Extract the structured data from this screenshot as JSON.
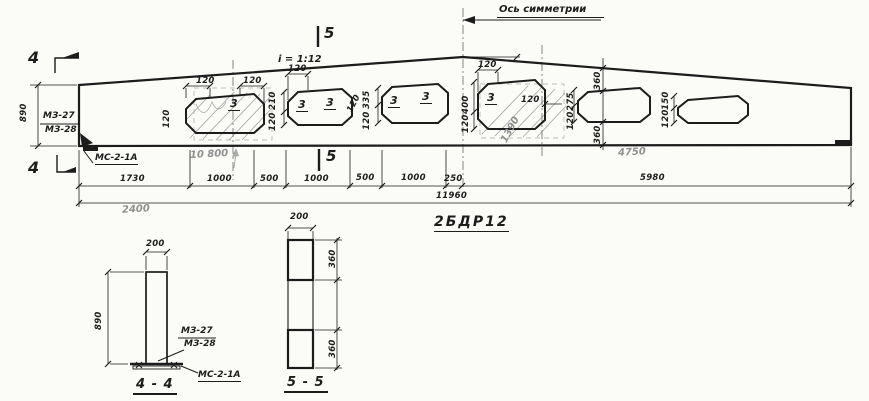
{
  "drawing": {
    "title": "2БДР12",
    "axis_label": "Ось симметрии",
    "slope_label": "i = 1:12",
    "section_4_title": "4 - 4",
    "section_5_title": "5 - 5",
    "markers": {
      "four": "4",
      "five": "5"
    },
    "part_labels": {
      "mz27": "МЗ-27",
      "mz28": "МЗ-28",
      "ms21a": "МС-2-1А"
    },
    "colors": {
      "ink": "#1c1c1c",
      "pencil": "#8f8f8f",
      "paper": "#fbfbf8"
    }
  },
  "labels": [
    {
      "name": "dim-120-o1-left-top",
      "text": "120",
      "x": 196,
      "y": 77,
      "cls": "dim"
    },
    {
      "name": "dim-120-o1-right-top",
      "text": "120",
      "x": 243,
      "y": 77,
      "cls": "dim"
    },
    {
      "name": "dim-120-o1-left",
      "text": "120",
      "x": 163,
      "y": 128,
      "cls": "dim rot"
    },
    {
      "name": "dim-210-o2",
      "text": "210",
      "x": 269,
      "y": 110,
      "cls": "dim rot"
    },
    {
      "name": "dim-120-o2",
      "text": "120",
      "x": 269,
      "y": 131,
      "cls": "dim rot"
    },
    {
      "name": "dim-120-o2-top",
      "text": "120",
      "x": 288,
      "y": 65,
      "cls": "dim"
    },
    {
      "name": "dim-120-between-o2-o3",
      "text": "120",
      "x": 346,
      "y": 110,
      "cls": "dim rot60"
    },
    {
      "name": "dim-335-o3",
      "text": "335",
      "x": 363,
      "y": 109,
      "cls": "dim rot"
    },
    {
      "name": "dim-120-o3",
      "text": "120",
      "x": 363,
      "y": 130,
      "cls": "dim rot"
    },
    {
      "name": "dim-120-o4-top",
      "text": "120",
      "x": 478,
      "y": 61,
      "cls": "dim"
    },
    {
      "name": "dim-400-o4",
      "text": "400",
      "x": 462,
      "y": 114,
      "cls": "dim rot"
    },
    {
      "name": "dim-120-o4",
      "text": "120",
      "x": 462,
      "y": 133,
      "cls": "dim rot"
    },
    {
      "name": "dim-120-o4-right",
      "text": "120",
      "x": 521,
      "y": 96,
      "cls": "dim"
    },
    {
      "name": "dim-1390-pencil",
      "text": "1390",
      "x": 500,
      "y": 140,
      "cls": "pencil rot60"
    },
    {
      "name": "dim-275-o5",
      "text": "275",
      "x": 567,
      "y": 111,
      "cls": "dim rot"
    },
    {
      "name": "dim-120-o5",
      "text": "120",
      "x": 567,
      "y": 130,
      "cls": "dim rot"
    },
    {
      "name": "dim-360-top",
      "text": "360",
      "x": 594,
      "y": 90,
      "cls": "dim rot"
    },
    {
      "name": "dim-360-bottom",
      "text": "360",
      "x": 594,
      "y": 144,
      "cls": "dim rot"
    },
    {
      "name": "dim-150-o6",
      "text": "150",
      "x": 662,
      "y": 110,
      "cls": "dim rot"
    },
    {
      "name": "dim-120-o6",
      "text": "120",
      "x": 662,
      "y": 128,
      "cls": "dim rot"
    },
    {
      "name": "opening-number-o1",
      "text": "3",
      "x": 228,
      "y": 98,
      "cls": "num"
    },
    {
      "name": "opening-number-o2a",
      "text": "3",
      "x": 296,
      "y": 99,
      "cls": "num"
    },
    {
      "name": "opening-number-o2b",
      "text": "3",
      "x": 324,
      "y": 97,
      "cls": "num"
    },
    {
      "name": "opening-number-o3a",
      "text": "3",
      "x": 388,
      "y": 95,
      "cls": "num"
    },
    {
      "name": "opening-number-o3b",
      "text": "3",
      "x": 420,
      "y": 91,
      "cls": "num"
    },
    {
      "name": "opening-number-o4",
      "text": "3",
      "x": 485,
      "y": 92,
      "cls": "num"
    },
    {
      "name": "dim-1730",
      "text": "1730",
      "x": 120,
      "y": 175,
      "cls": "dim"
    },
    {
      "name": "dim-1000-a",
      "text": "1000",
      "x": 207,
      "y": 175,
      "cls": "dim"
    },
    {
      "name": "dim-500-a",
      "text": "500",
      "x": 260,
      "y": 175,
      "cls": "dim"
    },
    {
      "name": "dim-1000-b",
      "text": "1000",
      "x": 304,
      "y": 175,
      "cls": "dim"
    },
    {
      "name": "dim-500-b",
      "text": "500",
      "x": 356,
      "y": 174,
      "cls": "dim"
    },
    {
      "name": "dim-1000-c",
      "text": "1000",
      "x": 401,
      "y": 174,
      "cls": "dim"
    },
    {
      "name": "dim-250",
      "text": "250",
      "x": 444,
      "y": 175,
      "cls": "dim"
    },
    {
      "name": "dim-5980",
      "text": "5980",
      "x": 640,
      "y": 174,
      "cls": "dim"
    },
    {
      "name": "dim-11960",
      "text": "11960",
      "x": 436,
      "y": 192,
      "cls": "dim"
    },
    {
      "name": "pencil-2400",
      "text": "2400",
      "x": 122,
      "y": 205,
      "cls": "pencil hand"
    },
    {
      "name": "pencil-10800",
      "text": "10 800",
      "x": 190,
      "y": 150,
      "cls": "pencil hand"
    },
    {
      "name": "pencil-4750",
      "text": "4750",
      "x": 618,
      "y": 148,
      "cls": "pencil hand"
    },
    {
      "name": "dim-890-elevation",
      "text": "890",
      "x": 20,
      "y": 122,
      "cls": "dim rot"
    },
    {
      "name": "dim-200-section4",
      "text": "200",
      "x": 146,
      "y": 240,
      "cls": "dim"
    },
    {
      "name": "dim-890-section4",
      "text": "890",
      "x": 95,
      "y": 330,
      "cls": "dim rot"
    },
    {
      "name": "dim-200-section5",
      "text": "200",
      "x": 290,
      "y": 213,
      "cls": "dim"
    },
    {
      "name": "dim-360-section5-top",
      "text": "360",
      "x": 329,
      "y": 268,
      "cls": "dim rot"
    },
    {
      "name": "dim-360-section5-bottom",
      "text": "360",
      "x": 329,
      "y": 358,
      "cls": "dim rot"
    }
  ]
}
